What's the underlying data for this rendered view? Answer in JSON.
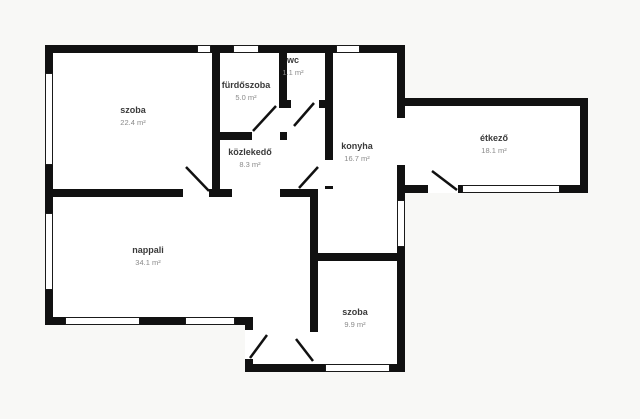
{
  "title": "apartment-floorplan",
  "colors": {
    "page_background": "#f8f8f6",
    "floor": "#ffffff",
    "wall": "#111111",
    "window_outline": "#1a1a1a",
    "door": "#111111",
    "room_name": "#3a3a3a",
    "room_area": "#8a8a8a"
  },
  "rooms": [
    {
      "id": "szoba-1",
      "name": "szoba",
      "area": "22.4 m²",
      "x": 133,
      "y": 113
    },
    {
      "id": "furdoszoba",
      "name": "fürdőszoba",
      "area": "5.0 m²",
      "x": 246,
      "y": 88
    },
    {
      "id": "wc",
      "name": "wc",
      "area": "1.1 m²",
      "x": 293,
      "y": 63
    },
    {
      "id": "kozlekedo",
      "name": "közlekedő",
      "area": "8.3 m²",
      "x": 250,
      "y": 155
    },
    {
      "id": "konyha",
      "name": "konyha",
      "area": "16.7 m²",
      "x": 357,
      "y": 149
    },
    {
      "id": "etkezo",
      "name": "étkező",
      "area": "18.1 m²",
      "x": 494,
      "y": 141
    },
    {
      "id": "nappali",
      "name": "nappali",
      "area": "34.1 m²",
      "x": 148,
      "y": 253
    },
    {
      "id": "szoba-2",
      "name": "szoba",
      "area": "9.9 m²",
      "x": 355,
      "y": 315
    }
  ],
  "floorplan": {
    "canvas": {
      "width": 640,
      "height": 419
    },
    "wall_thickness": 8,
    "floors": [
      {
        "x": 45,
        "y": 45,
        "w": 273,
        "h": 280
      },
      {
        "x": 310,
        "y": 45,
        "w": 95,
        "h": 327
      },
      {
        "x": 397,
        "y": 98,
        "w": 191,
        "h": 95
      },
      {
        "x": 245,
        "y": 317,
        "w": 73,
        "h": 55
      }
    ],
    "walls": [
      {
        "x": 45,
        "y": 45,
        "w": 360,
        "h": 8
      },
      {
        "x": 45,
        "y": 45,
        "w": 8,
        "h": 280
      },
      {
        "x": 45,
        "y": 189,
        "w": 273,
        "h": 8
      },
      {
        "x": 45,
        "y": 317,
        "w": 208,
        "h": 8
      },
      {
        "x": 245,
        "y": 317,
        "w": 8,
        "h": 55
      },
      {
        "x": 245,
        "y": 364,
        "w": 160,
        "h": 8
      },
      {
        "x": 212,
        "y": 53,
        "w": 8,
        "h": 136
      },
      {
        "x": 279,
        "y": 53,
        "w": 8,
        "h": 55
      },
      {
        "x": 279,
        "y": 100,
        "w": 54,
        "h": 8
      },
      {
        "x": 325,
        "y": 45,
        "w": 8,
        "h": 144
      },
      {
        "x": 212,
        "y": 132,
        "w": 75,
        "h": 8
      },
      {
        "x": 310,
        "y": 189,
        "w": 8,
        "h": 143
      },
      {
        "x": 310,
        "y": 253,
        "w": 95,
        "h": 8
      },
      {
        "x": 397,
        "y": 45,
        "w": 8,
        "h": 216
      },
      {
        "x": 397,
        "y": 261,
        "w": 8,
        "h": 111
      },
      {
        "x": 405,
        "y": 98,
        "w": 183,
        "h": 8
      },
      {
        "x": 580,
        "y": 98,
        "w": 8,
        "h": 95
      },
      {
        "x": 405,
        "y": 185,
        "w": 183,
        "h": 8
      }
    ],
    "door_openings": [
      {
        "x": 183,
        "y": 189,
        "w": 26,
        "h": 8
      },
      {
        "x": 232,
        "y": 189,
        "w": 48,
        "h": 8
      },
      {
        "x": 252,
        "y": 132,
        "w": 28,
        "h": 8
      },
      {
        "x": 291,
        "y": 100,
        "w": 28,
        "h": 8
      },
      {
        "x": 325,
        "y": 160,
        "w": 8,
        "h": 26
      },
      {
        "x": 397,
        "y": 118,
        "w": 8,
        "h": 47
      },
      {
        "x": 428,
        "y": 185,
        "w": 30,
        "h": 8
      },
      {
        "x": 245,
        "y": 330,
        "w": 8,
        "h": 29
      },
      {
        "x": 310,
        "y": 332,
        "w": 8,
        "h": 32
      }
    ],
    "windows": [
      {
        "x": 45,
        "y": 73,
        "w": 8,
        "h": 92
      },
      {
        "x": 45,
        "y": 213,
        "w": 8,
        "h": 77
      },
      {
        "x": 65,
        "y": 317,
        "w": 75,
        "h": 8
      },
      {
        "x": 185,
        "y": 317,
        "w": 50,
        "h": 8
      },
      {
        "x": 325,
        "y": 364,
        "w": 65,
        "h": 8
      },
      {
        "x": 397,
        "y": 200,
        "w": 8,
        "h": 47
      },
      {
        "x": 462,
        "y": 185,
        "w": 98,
        "h": 8
      },
      {
        "x": 197,
        "y": 45,
        "w": 14,
        "h": 8
      },
      {
        "x": 233,
        "y": 45,
        "w": 26,
        "h": 8
      },
      {
        "x": 336,
        "y": 45,
        "w": 24,
        "h": 8
      }
    ],
    "door_swings": [
      {
        "x1": 186,
        "y1": 167,
        "x2": 209,
        "y2": 191
      },
      {
        "x1": 253,
        "y1": 131,
        "x2": 276,
        "y2": 106
      },
      {
        "x1": 294,
        "y1": 126,
        "x2": 314,
        "y2": 103
      },
      {
        "x1": 299,
        "y1": 188,
        "x2": 318,
        "y2": 167
      },
      {
        "x1": 432,
        "y1": 171,
        "x2": 457,
        "y2": 190
      },
      {
        "x1": 250,
        "y1": 358,
        "x2": 267,
        "y2": 335
      },
      {
        "x1": 296,
        "y1": 339,
        "x2": 313,
        "y2": 361
      }
    ]
  }
}
